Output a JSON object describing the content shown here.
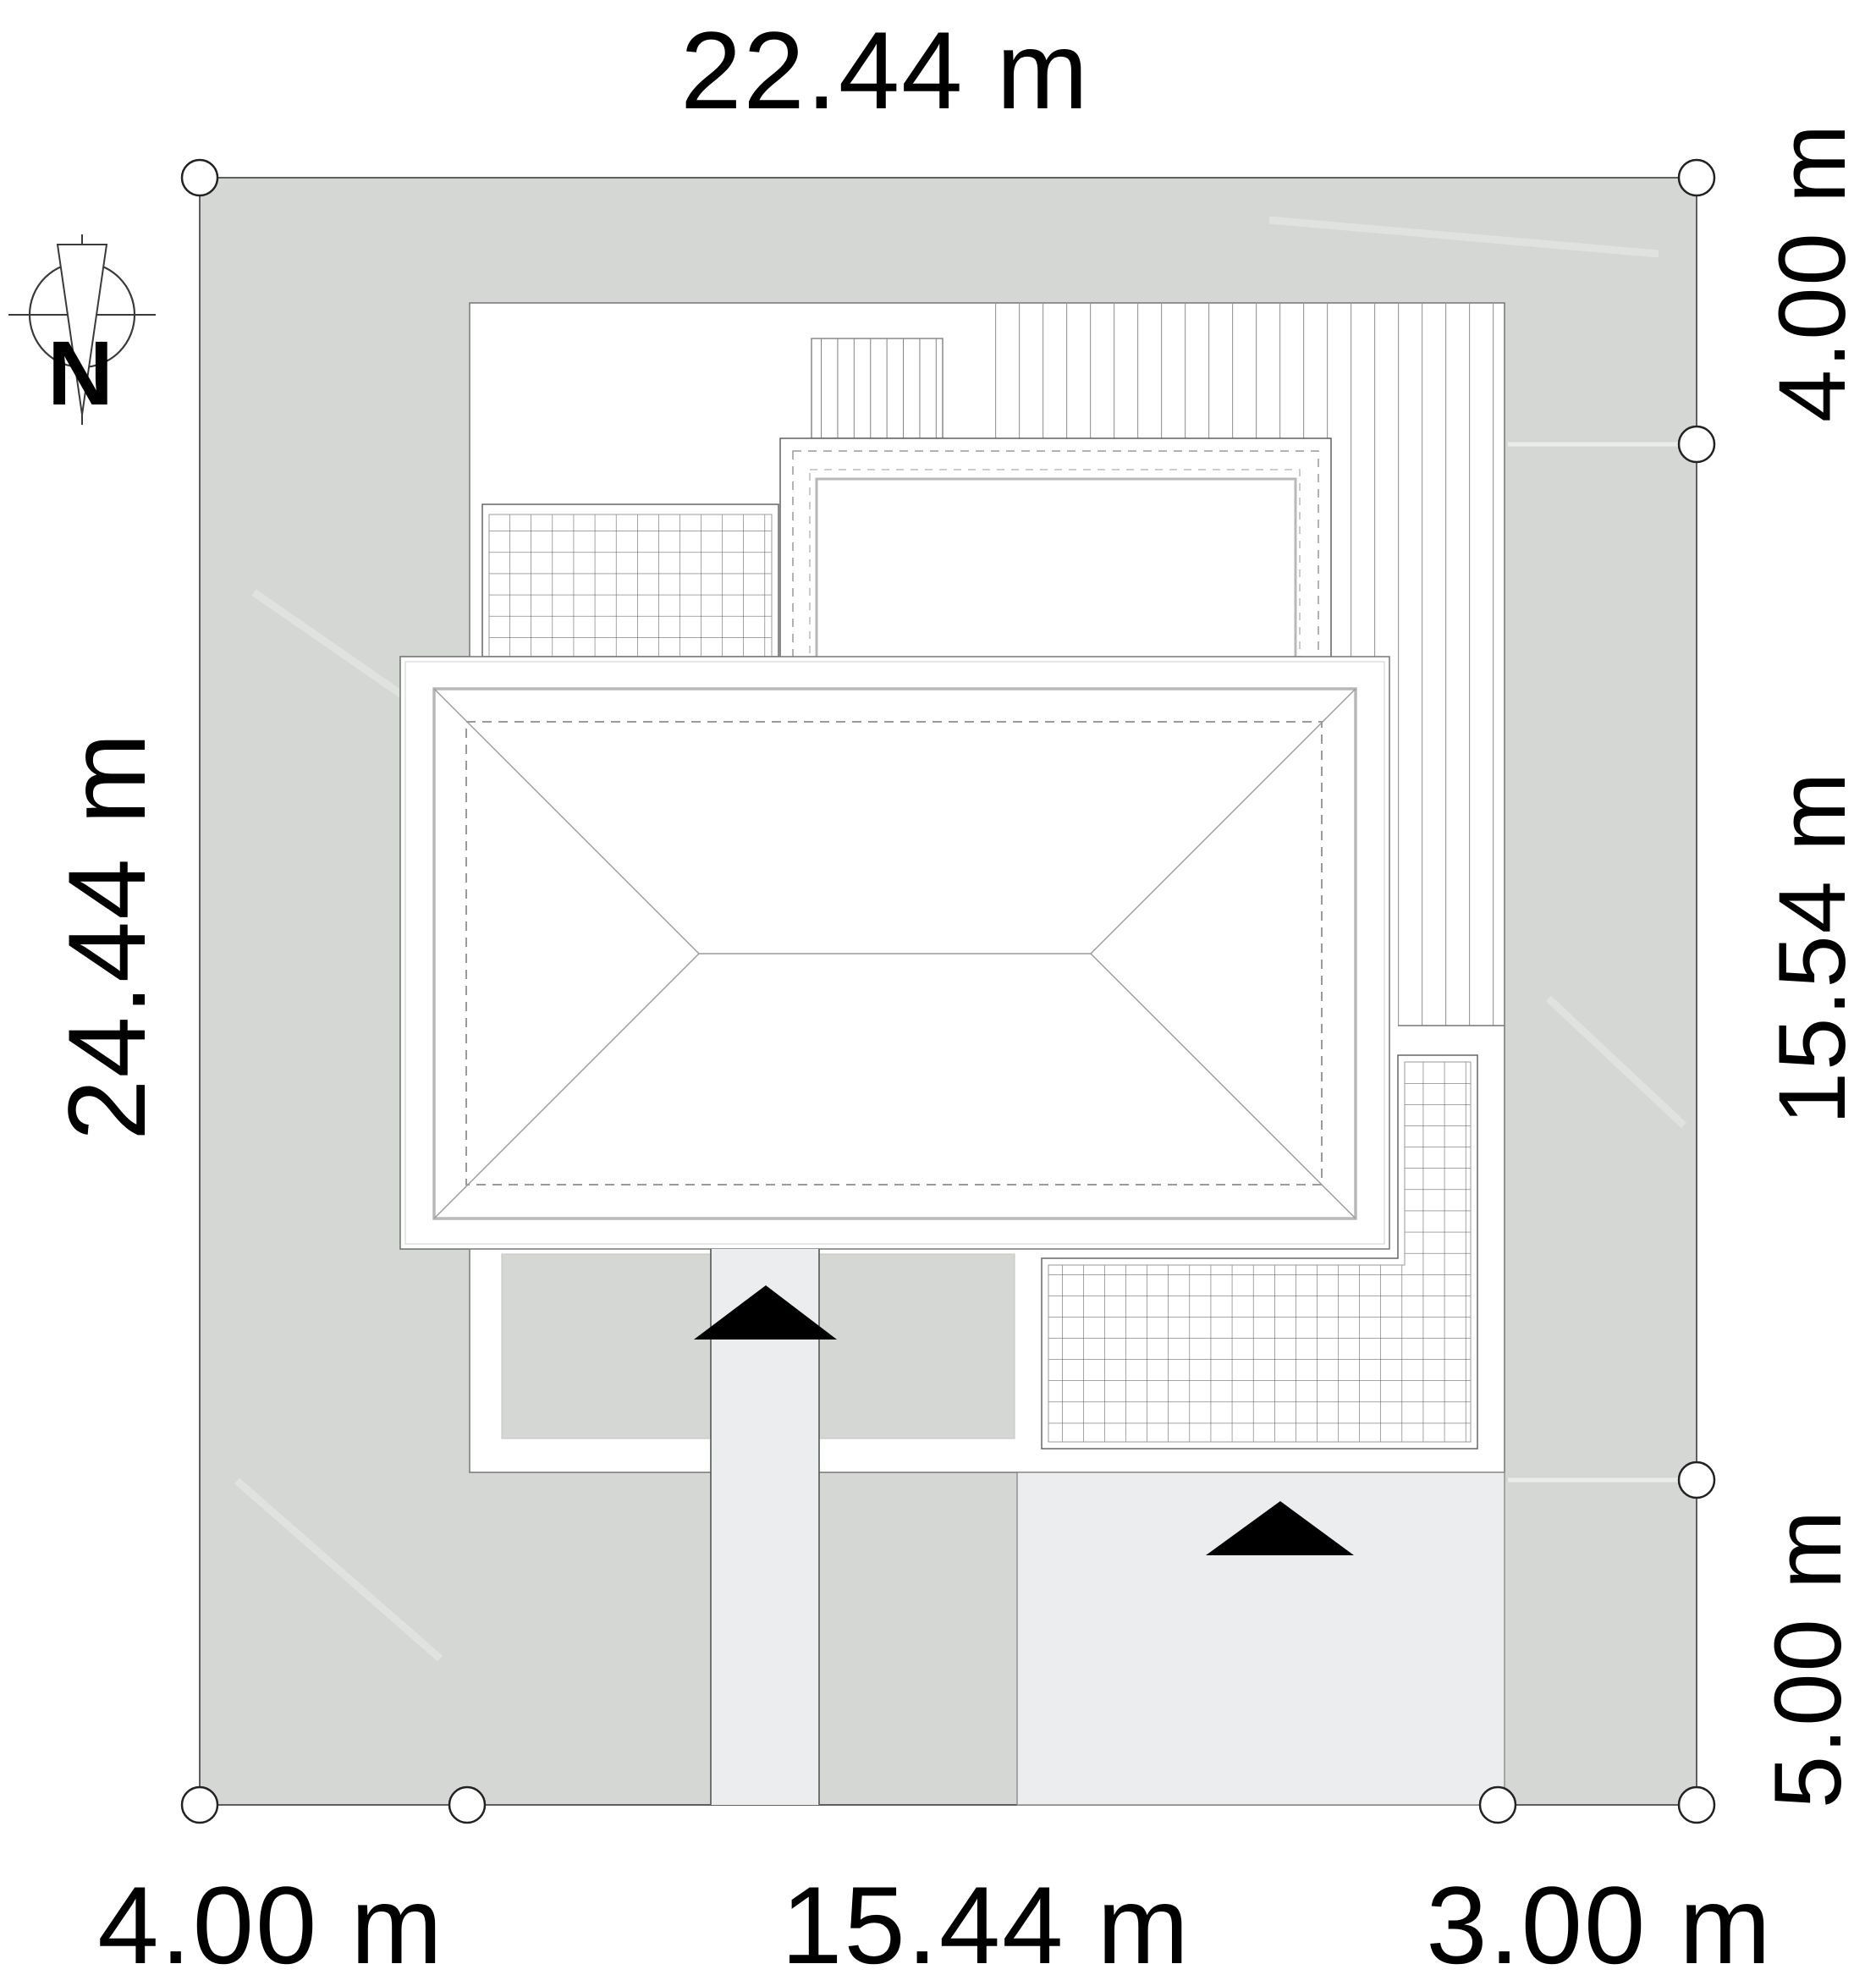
{
  "plan": {
    "compass": {
      "north_label": "N"
    },
    "dimensions": {
      "top": "22.44 m",
      "left": "24.44 m",
      "right_top": "4.00 m",
      "right_middle": "15.54 m",
      "right_bottom": "5.00 m",
      "bottom_left": "4.00 m",
      "bottom_middle": "15.44 m",
      "bottom_right": "3.00 m"
    },
    "colors": {
      "plot_fill": "#d5d7d4",
      "paving_fill": "#ebedee",
      "surface_white": "#ffffff",
      "outline_dark": "#3c3c3c",
      "outline_mid": "#777777",
      "grid_line": "#4a4a4a",
      "board_line": "#9c9c9c",
      "roof_eave": "#b8b8b8",
      "roof_line": "#9a9a9a",
      "arrow": "#000000"
    }
  }
}
